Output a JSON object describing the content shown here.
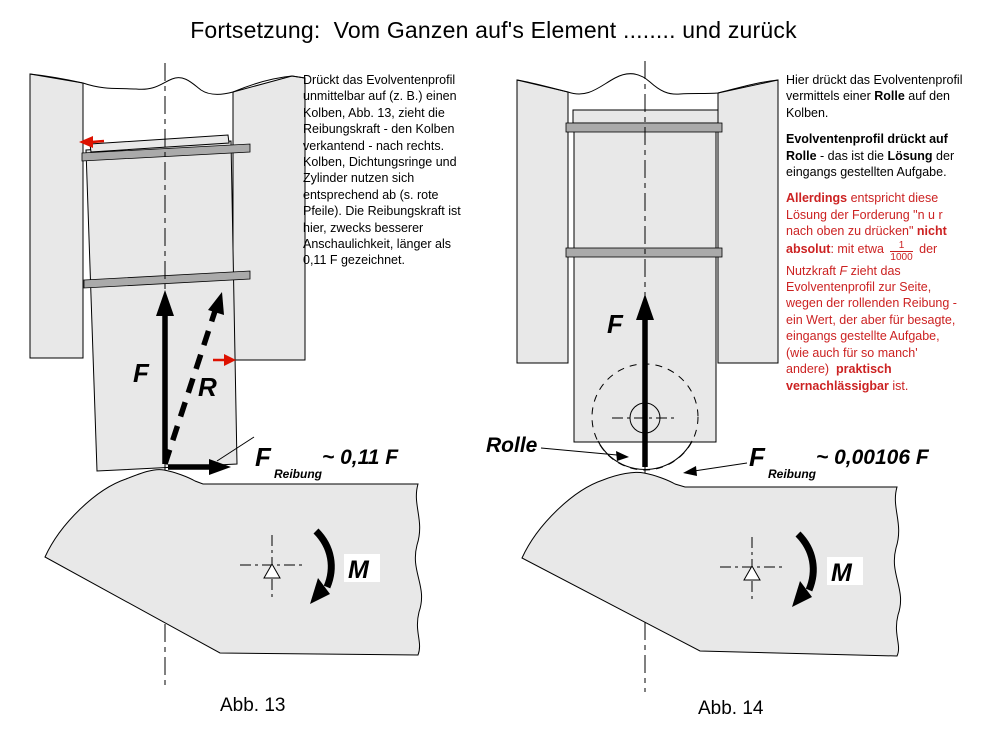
{
  "title": "Fortsetzung:  Vom Ganzen auf's Element ........ und zurück",
  "colors": {
    "red-text": "#cc2222",
    "red-arrow": "#dd1100",
    "fill-gray": "#e8e8e8",
    "ring-gray": "#aaaaaa"
  },
  "left_note": {
    "lines": [
      {
        "runs": [
          {
            "t": "Drückt das Evolventenprofil"
          }
        ]
      },
      {
        "runs": [
          {
            "t": "unmittelbar auf (z. B.) einen"
          }
        ]
      },
      {
        "runs": [
          {
            "t": "Kolben, Abb. 13, zieht die"
          }
        ]
      },
      {
        "runs": [
          {
            "t": "Reibungskraft - den Kolben"
          }
        ]
      },
      {
        "runs": [
          {
            "t": "verkantend - nach rechts."
          }
        ]
      },
      {
        "runs": [
          {
            "t": "Kolben, Dichtungsringe und"
          }
        ]
      },
      {
        "runs": [
          {
            "t": "Zylinder nutzen sich"
          }
        ]
      },
      {
        "runs": [
          {
            "t": "entsprechend ab (s. rote"
          }
        ]
      },
      {
        "runs": [
          {
            "t": "Pfeile). Die Reibungskraft ist"
          }
        ]
      },
      {
        "runs": [
          {
            "t": "hier, zwecks besserer"
          }
        ]
      },
      {
        "runs": [
          {
            "t": "Anschaulichkeit, länger als"
          }
        ]
      },
      {
        "runs": [
          {
            "t": "0,11 F gezeichnet."
          }
        ]
      }
    ]
  },
  "right_note": {
    "lines": [
      {
        "runs": [
          {
            "t": "Hier drückt das Evolventenprofil"
          }
        ]
      },
      {
        "runs": [
          {
            "t": "vermittels einer "
          },
          {
            "t": "Rolle",
            "b": 1
          },
          {
            "t": " auf den"
          }
        ]
      },
      {
        "runs": [
          {
            "t": "Kolben."
          }
        ]
      },
      {
        "gap": 1,
        "runs": [
          {
            "t": "Evolventenprofil drückt auf",
            "b": 1
          }
        ]
      },
      {
        "runs": [
          {
            "t": "Rolle",
            "b": 1
          },
          {
            "t": " - das ist die "
          },
          {
            "t": "Lösung",
            "b": 1
          },
          {
            "t": " der"
          }
        ]
      },
      {
        "runs": [
          {
            "t": "eingangs gestellten Aufgabe."
          }
        ]
      },
      {
        "gap": 1,
        "red": 1,
        "runs": [
          {
            "t": "Allerdings",
            "b": 1
          },
          {
            "t": " entspricht diese"
          }
        ]
      },
      {
        "red": 1,
        "runs": [
          {
            "t": "Lösung der Forderung \"n u r"
          }
        ]
      },
      {
        "red": 1,
        "runs": [
          {
            "t": "nach oben zu drücken\" "
          },
          {
            "t": "nicht",
            "b": 1
          }
        ]
      },
      {
        "red": 1,
        "runs": [
          {
            "t": "absolut",
            "b": 1
          },
          {
            "t": ": mit etwa "
          },
          {
            "frac": [
              "1",
              "1000"
            ]
          },
          {
            "t": " der"
          }
        ]
      },
      {
        "red": 1,
        "runs": [
          {
            "t": "Nutzkraft "
          },
          {
            "t": "F",
            "i": 1
          },
          {
            "t": " zieht das"
          }
        ]
      },
      {
        "red": 1,
        "runs": [
          {
            "t": "Evolventenprofil zur Seite,"
          }
        ]
      },
      {
        "red": 1,
        "runs": [
          {
            "t": "wegen der rollenden Reibung -"
          }
        ]
      },
      {
        "red": 1,
        "runs": [
          {
            "t": "ein Wert, der aber für besagte,"
          }
        ]
      },
      {
        "red": 1,
        "runs": [
          {
            "t": "eingangs gestellte Aufgabe,"
          }
        ]
      },
      {
        "red": 1,
        "runs": [
          {
            "t": "(wie auch für so manch'"
          }
        ]
      },
      {
        "red": 1,
        "runs": [
          {
            "t": "andere)  "
          },
          {
            "t": "praktisch",
            "b": 1
          }
        ]
      },
      {
        "red": 1,
        "runs": [
          {
            "t": "vernachlässigbar",
            "b": 1
          },
          {
            "t": " ist."
          }
        ]
      }
    ]
  },
  "fig13": {
    "force_label": "F",
    "resultant_label": "R",
    "friction_main": "F",
    "friction_sub": "Reibung",
    "friction_value": "~  0,11 F",
    "moment_label": "M",
    "caption": "Abb. 13"
  },
  "fig14": {
    "force_label": "F",
    "roller_label": "Rolle",
    "friction_main": "F",
    "friction_sub": "Reibung",
    "friction_value": "~  0,00106 F",
    "moment_label": "M",
    "caption": "Abb. 14"
  }
}
